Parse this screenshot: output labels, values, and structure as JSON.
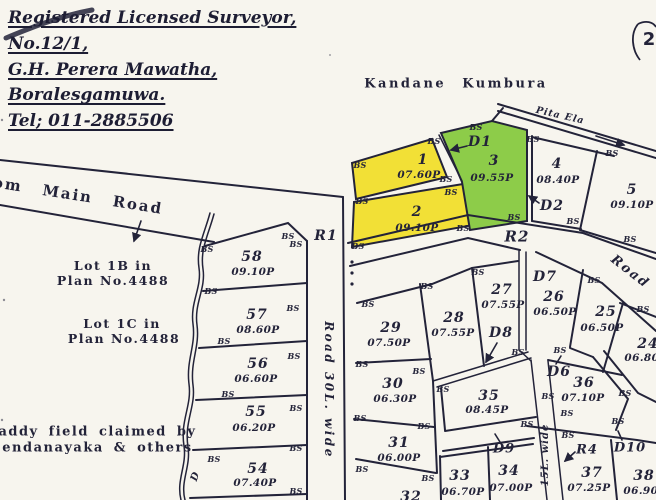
{
  "surveyor": {
    "line1": "Registered Licensed Surveyor,",
    "line2": "No.12/1,",
    "line3": "G.H. Perera Mawatha,",
    "line4": "Boralesgamuwa.",
    "line5": "Tel; 011-2885506"
  },
  "page_mark": "2",
  "area_labels": {
    "kandane_kumbura": "Kandane Kumbura",
    "pita_ela": "Pita Ela",
    "main_road": "om Main Road",
    "road_right": "Road",
    "road_30": "Road 30L. wide",
    "road_15": "15L. wide",
    "lot_1b_line1": "Lot 1B in",
    "lot_1b_line2": "Plan No.4488",
    "lot_1c_line1": "Lot 1C in",
    "lot_1c_line2": "Plan No.4488",
    "paddy_line1": "Paddy field claimed by",
    "paddy_line2": "Sendanayaka & others",
    "stream_letter": "D",
    "bs": "BS"
  },
  "road_refs": {
    "r1": "R1",
    "r2": "R2",
    "r4": "R4"
  },
  "drain_refs": {
    "d1": "D1",
    "d2": "D2",
    "d6": "D6",
    "d7": "D7",
    "d8": "D8",
    "d9": "D9",
    "d10": "D10"
  },
  "lots": {
    "l1": {
      "no": "1",
      "area": "07.60P"
    },
    "l2": {
      "no": "2",
      "area": "09.10P"
    },
    "l3": {
      "no": "3",
      "area": "09.55P"
    },
    "l4": {
      "no": "4",
      "area": "08.40P"
    },
    "l5": {
      "no": "5",
      "area": "09.10P"
    },
    "l24": {
      "no": "24",
      "area": "06.80P"
    },
    "l25": {
      "no": "25",
      "area": "06.50P"
    },
    "l26": {
      "no": "26",
      "area": "06.50P"
    },
    "l27": {
      "no": "27",
      "area": "07.55P"
    },
    "l28": {
      "no": "28",
      "area": "07.55P"
    },
    "l29": {
      "no": "29",
      "area": "07.50P"
    },
    "l30": {
      "no": "30",
      "area": "06.30P"
    },
    "l31": {
      "no": "31",
      "area": "06.00P"
    },
    "l32": {
      "no": "32",
      "area": ""
    },
    "l33": {
      "no": "33",
      "area": "06.70P"
    },
    "l34": {
      "no": "34",
      "area": "07.00P"
    },
    "l35": {
      "no": "35",
      "area": "08.45P"
    },
    "l36": {
      "no": "36",
      "area": "07.10P"
    },
    "l37": {
      "no": "37",
      "area": "07.25P"
    },
    "l38": {
      "no": "38",
      "area": "06.90P"
    },
    "l54": {
      "no": "54",
      "area": "07.40P"
    },
    "l55": {
      "no": "55",
      "area": "06.20P"
    },
    "l56": {
      "no": "56",
      "area": "06.60P"
    },
    "l57": {
      "no": "57",
      "area": "08.60P"
    },
    "l58": {
      "no": "58",
      "area": "09.10P"
    }
  },
  "colors": {
    "highlight_yellow": "#f2e036",
    "highlight_green": "#8dcc49",
    "ink": "#232339",
    "paper": "#f7f5ee"
  }
}
